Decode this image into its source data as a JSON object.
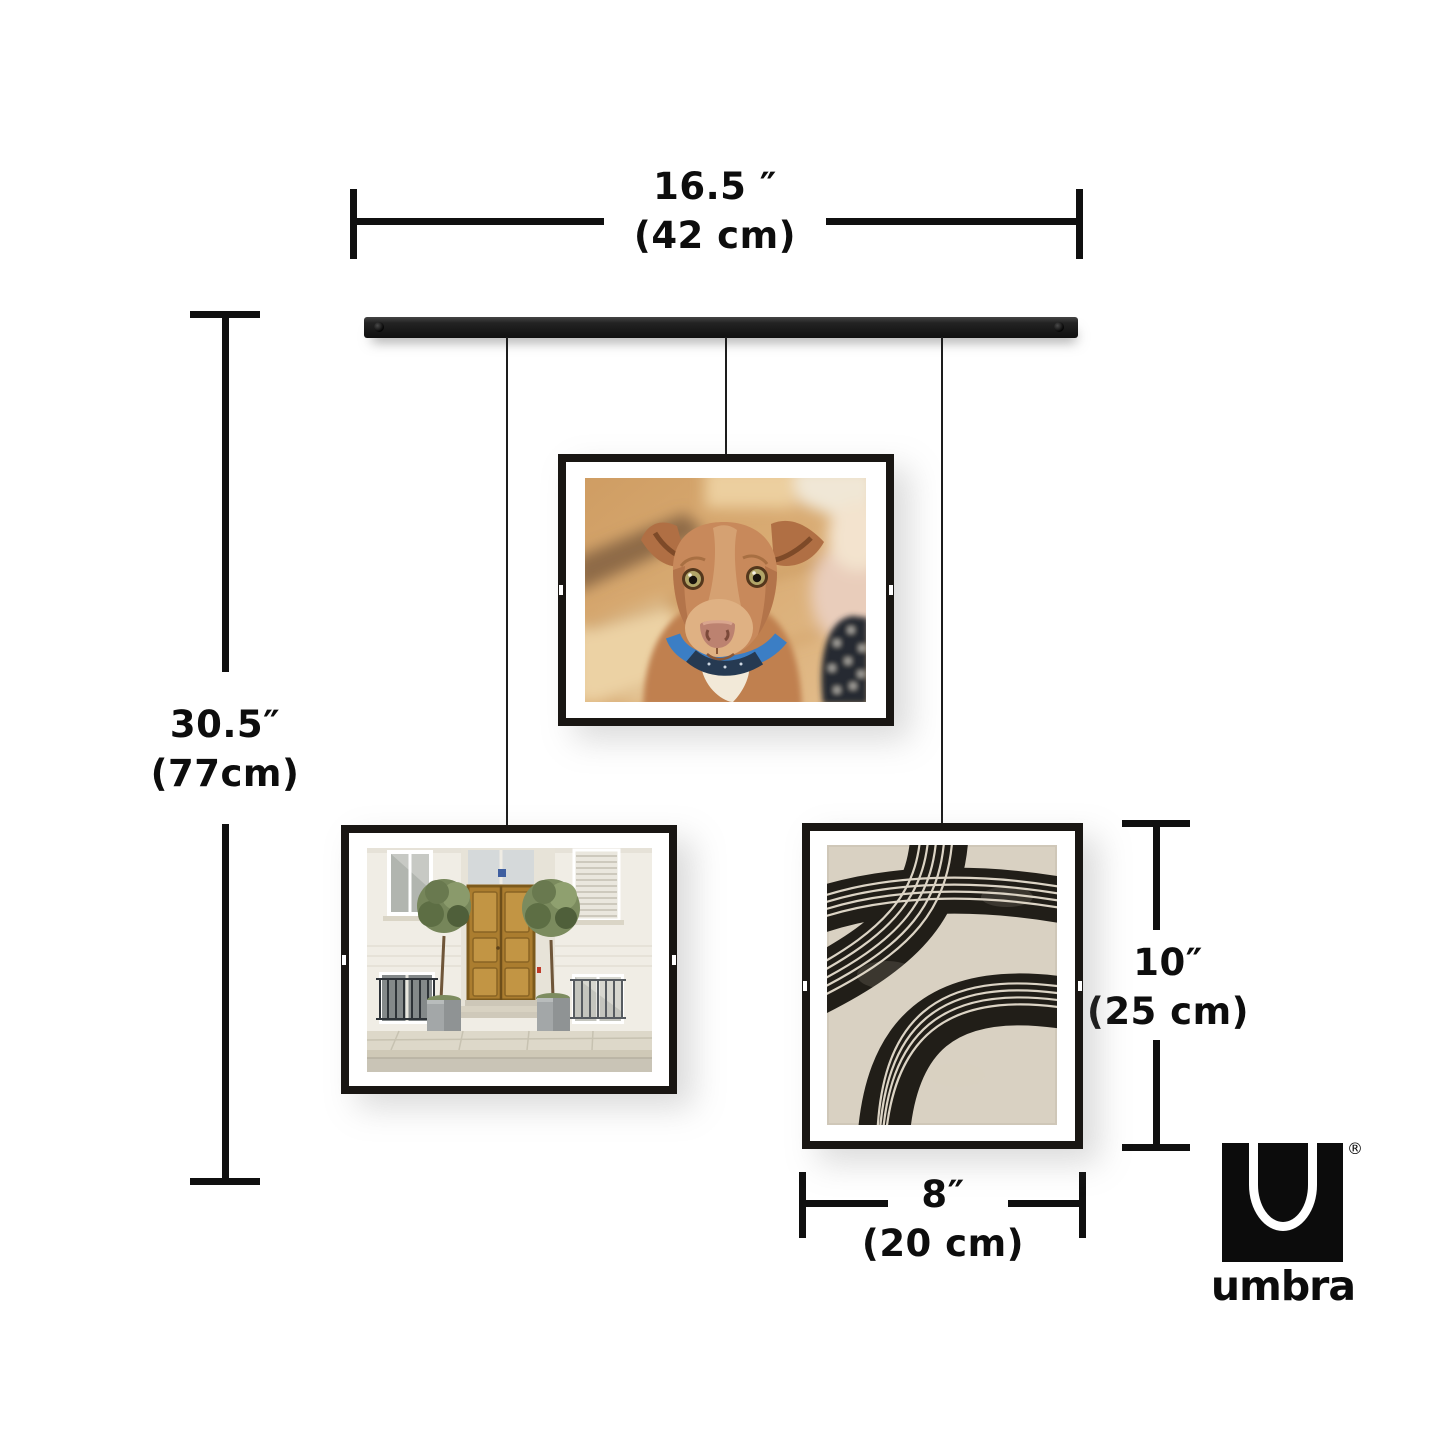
{
  "dimensions": {
    "rail_width": {
      "inches": "16.5 ″",
      "cm": "(42 cm)"
    },
    "total_drop": {
      "inches": "30.5″",
      "cm": "(77cm)"
    },
    "frame_height": {
      "inches": "10″",
      "cm": "(25 cm)"
    },
    "frame_width": {
      "inches": "8″",
      "cm": "(20 cm)"
    }
  },
  "brand": {
    "wordmark": "umbra",
    "registered_mark": "®"
  },
  "product": {
    "type": "hanging picture display with rail and three wire-hung float frames",
    "frames": [
      {
        "id": "center",
        "subject": "dog portrait photo"
      },
      {
        "id": "left",
        "subject": "building entrance with wooden door and potted trees photo"
      },
      {
        "id": "right",
        "subject": "abstract black brush arcs print on beige paper"
      }
    ]
  },
  "colors": {
    "background": "#ffffff",
    "dimension_line": "#101010",
    "rail": "#1f1f1f",
    "frame": "#191613",
    "art_paper": "#d9d1c2",
    "art_ink": "#211e18"
  }
}
